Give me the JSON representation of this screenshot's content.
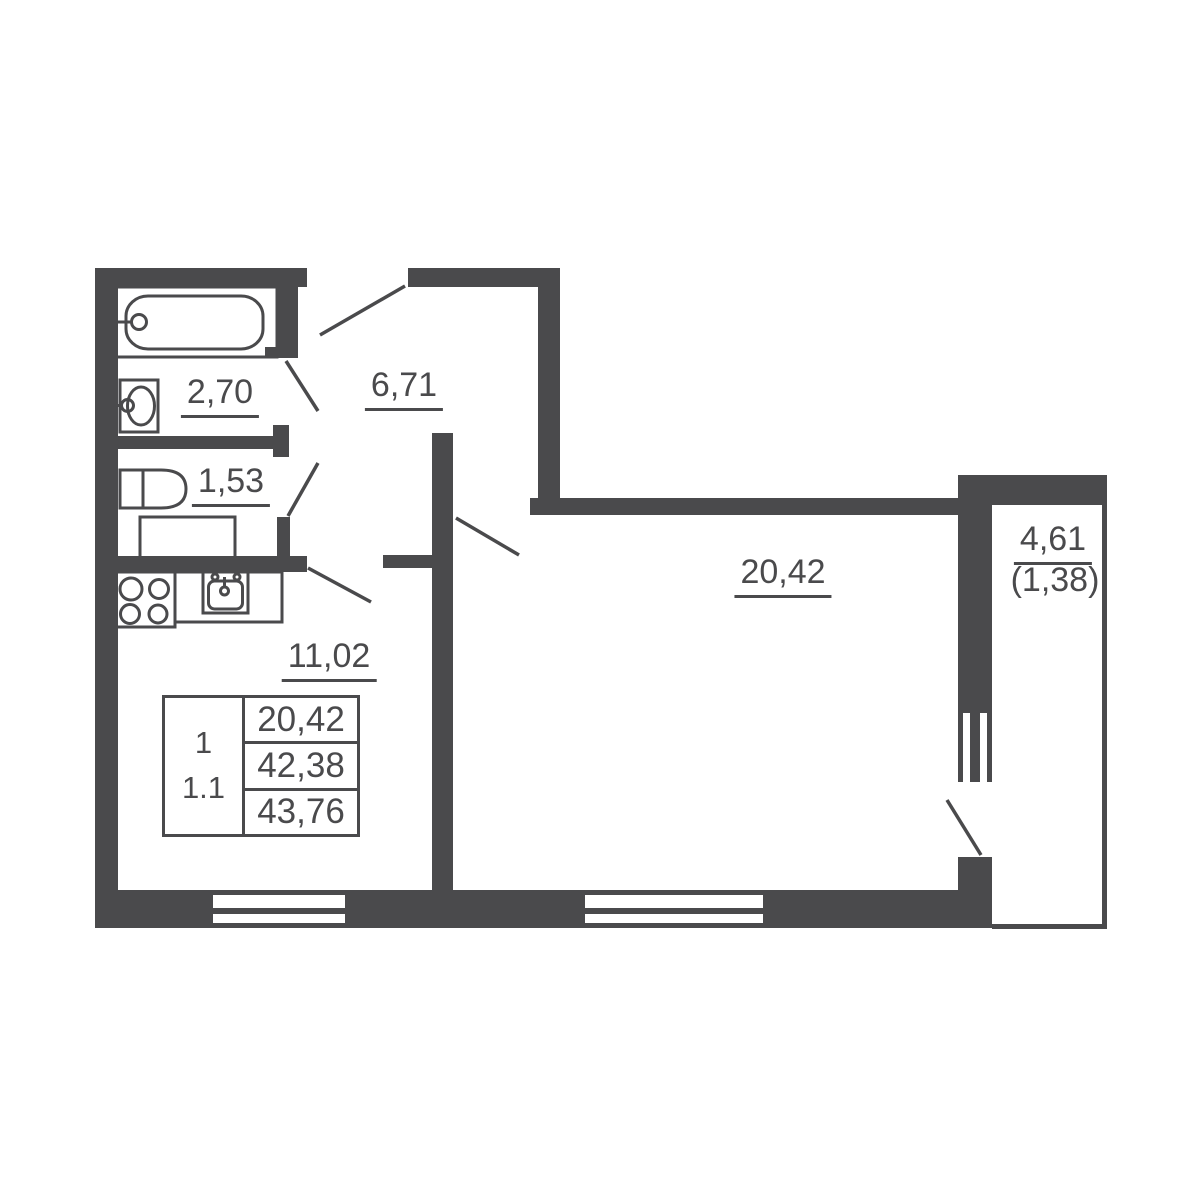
{
  "plan": {
    "rooms": {
      "bathroom": {
        "area": "2,70"
      },
      "toilet": {
        "area": "1,53"
      },
      "hallway": {
        "area": "6,71"
      },
      "kitchen": {
        "area": "11,02"
      },
      "living_room": {
        "area": "20,42"
      },
      "balcony": {
        "area": "4,61",
        "area_secondary": "(1,38)"
      }
    },
    "info_table": {
      "rooms_count": "1",
      "unit_type": "1.1",
      "living_area": "20,42",
      "apartment_area": "42,38",
      "total_area": "43,76"
    },
    "colors": {
      "wall": "#4a4a4c",
      "background": "#ffffff"
    }
  }
}
